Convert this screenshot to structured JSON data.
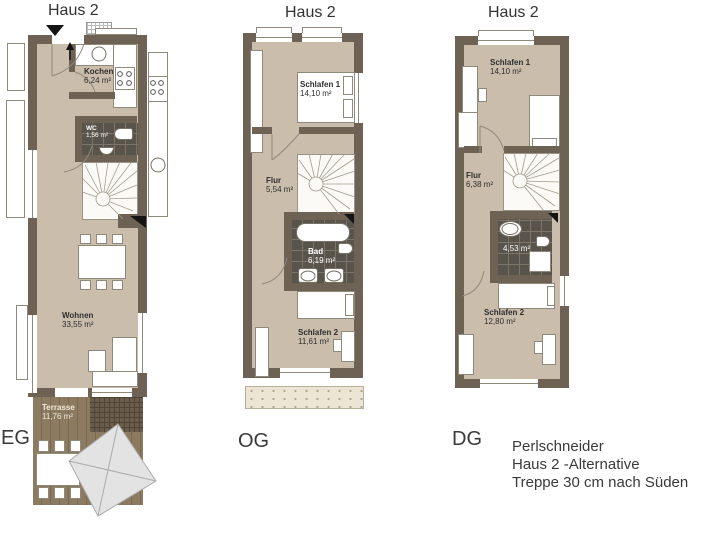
{
  "plans": [
    {
      "title": "Haus 2",
      "floor_label": "EG",
      "rooms": [
        {
          "name": "Kochen",
          "area": "6,24 m²"
        },
        {
          "name": "WC",
          "area": "1,56 m²"
        },
        {
          "name": "Wohnen",
          "area": "33,55 m²"
        },
        {
          "name": "Terrasse",
          "area": "11,76 m²"
        }
      ]
    },
    {
      "title": "Haus 2",
      "floor_label": "OG",
      "rooms": [
        {
          "name": "Schlafen 1",
          "area": "14,10 m²"
        },
        {
          "name": "Flur",
          "area": "5,54 m²"
        },
        {
          "name": "Bad",
          "area": "6,19 m²"
        },
        {
          "name": "Schlafen 2",
          "area": "11,61 m²"
        }
      ]
    },
    {
      "title": "Haus 2",
      "floor_label": "DG",
      "rooms": [
        {
          "name": "Schlafen 1",
          "area": "14,10 m²"
        },
        {
          "name": "Flur",
          "area": "6,38 m²"
        },
        {
          "name": "",
          "area": "4,53 m²"
        },
        {
          "name": "Schlafen 2",
          "area": "12,80 m²"
        }
      ]
    }
  ],
  "notes": {
    "line1": "Perlschneider",
    "line2": "Haus 2 -Alternative",
    "line3": "Treppe  30 cm nach Süden"
  },
  "colors": {
    "wall": "#6e6254",
    "floor": "#cabdac",
    "bath_tile": "#59544b",
    "terrace_deck": "#8c7b60",
    "parasol": "#e3e3e3",
    "background": "#ffffff"
  }
}
